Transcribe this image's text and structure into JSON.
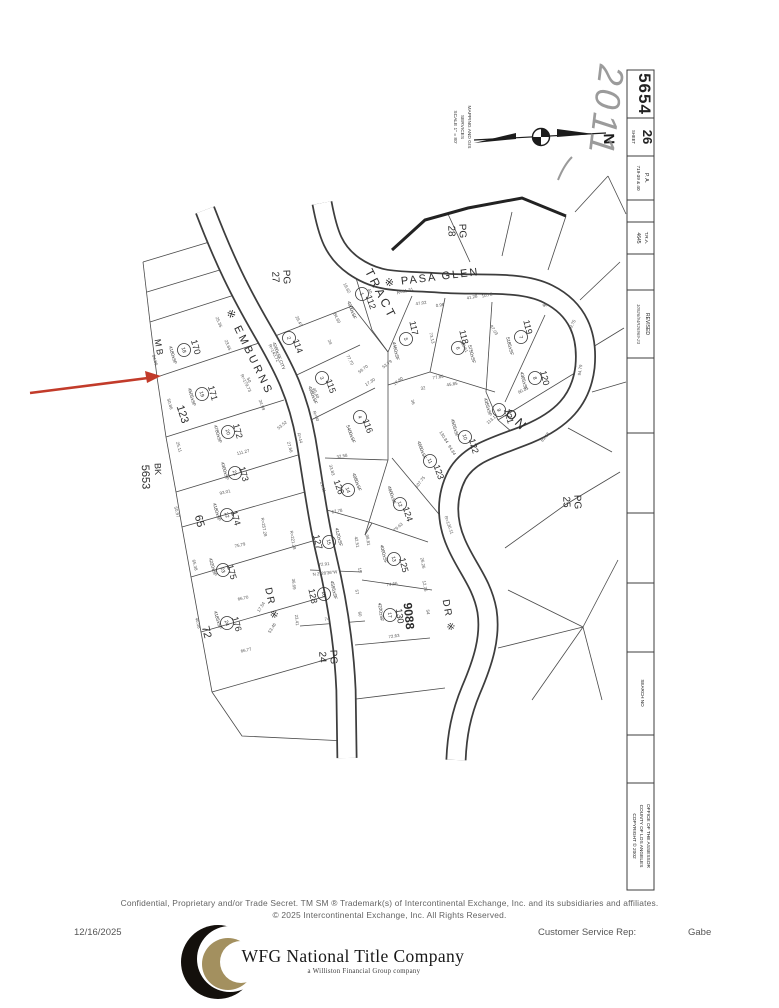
{
  "sidebar": {
    "book": "5654",
    "sheet_label": "SHEET",
    "sheet": "26",
    "pa_label": "P. A.",
    "pa_value": "719-39 & 40",
    "tra_label": "T.R.A.",
    "tra_value": "4645",
    "revised_label": "REVISED",
    "revised_value": "10926/94R26969-23",
    "search_label": "SEARCH NO",
    "office_line1": "OFFICE OF THE ASSESSOR",
    "office_line2": "COUNTY OF LOS ANGELES",
    "office_line3": "COPYRIGHT © 2002"
  },
  "compass": {
    "north": "N",
    "caption_line1": "MAPPING AND GIS",
    "caption_line2": "SERVICES",
    "caption_line3": "SCALE 1\" = 80'"
  },
  "annotations": {
    "handwritten_year": "2011",
    "pointer_color": "#c23b2a"
  },
  "map": {
    "labels": [
      {
        "t": "※ EMBURNS",
        "x": 250,
        "y": 352,
        "r": 64,
        "s": 11,
        "ls": 3
      },
      {
        "t": "DR ※",
        "x": 272,
        "y": 604,
        "r": 78,
        "s": 10,
        "ls": 2
      },
      {
        "t": "※ PASA GLEN",
        "x": 432,
        "y": 277,
        "r": -7,
        "s": 11,
        "ls": 2
      },
      {
        "t": "DR ※",
        "x": 449,
        "y": 616,
        "r": 80,
        "s": 10,
        "ls": 2
      },
      {
        "t": "TRACT",
        "x": 381,
        "y": 294,
        "r": 63,
        "s": 12,
        "ls": 3
      },
      {
        "t": "ON",
        "x": 517,
        "y": 420,
        "r": 45,
        "s": 13,
        "ls": 3
      },
      {
        "t": "9088",
        "x": 409,
        "y": 616,
        "r": 84,
        "s": 12,
        "w": 1
      },
      {
        "t": "M B",
        "x": 159,
        "y": 347,
        "r": 80,
        "s": 9
      },
      {
        "t": "BK",
        "x": 158,
        "y": 469,
        "r": 88,
        "s": 9
      },
      {
        "t": "5653",
        "x": 146,
        "y": 477,
        "r": 88,
        "s": 11
      },
      {
        "t": "PG",
        "x": 287,
        "y": 277,
        "r": 88,
        "s": 10
      },
      {
        "t": "27",
        "x": 276,
        "y": 277,
        "r": 88,
        "s": 10
      },
      {
        "t": "PG",
        "x": 463,
        "y": 231,
        "r": 88,
        "s": 10
      },
      {
        "t": "28",
        "x": 452,
        "y": 231,
        "r": 88,
        "s": 10
      },
      {
        "t": "PG",
        "x": 578,
        "y": 502,
        "r": 88,
        "s": 10
      },
      {
        "t": "25",
        "x": 567,
        "y": 502,
        "r": 88,
        "s": 10
      },
      {
        "t": "PG",
        "x": 334,
        "y": 657,
        "r": 88,
        "s": 10
      },
      {
        "t": "24",
        "x": 323,
        "y": 657,
        "r": 88,
        "s": 10
      },
      {
        "t": "123",
        "x": 183,
        "y": 414,
        "r": 72,
        "s": 11
      },
      {
        "t": "65",
        "x": 200,
        "y": 521,
        "r": 76,
        "s": 11
      },
      {
        "t": "72",
        "x": 207,
        "y": 632,
        "r": 76,
        "s": 11
      },
      {
        "t": "112",
        "x": 371,
        "y": 302,
        "r": 70,
        "s": 9
      },
      {
        "t": "1",
        "x": 362,
        "y": 294,
        "r": 70,
        "s": 5,
        "c": 1
      },
      {
        "t": "4000±SF",
        "x": 352,
        "y": 310,
        "r": 70,
        "s": 4.6
      },
      {
        "t": "114",
        "x": 298,
        "y": 346,
        "r": 70,
        "s": 9
      },
      {
        "t": "2",
        "x": 289,
        "y": 338,
        "r": 70,
        "s": 5,
        "c": 1
      },
      {
        "t": "4200±SF CITY",
        "x": 279,
        "y": 356,
        "r": 70,
        "s": 4.4
      },
      {
        "t": "115",
        "x": 331,
        "y": 386,
        "r": 70,
        "s": 9
      },
      {
        "t": "3",
        "x": 322,
        "y": 378,
        "r": 70,
        "s": 5,
        "c": 1
      },
      {
        "t": "4080±SF",
        "x": 313,
        "y": 395,
        "r": 70,
        "s": 4.6
      },
      {
        "t": "116",
        "x": 368,
        "y": 426,
        "r": 70,
        "s": 9
      },
      {
        "t": "4",
        "x": 360,
        "y": 417,
        "r": 70,
        "s": 5,
        "c": 1
      },
      {
        "t": "5400±SF",
        "x": 351,
        "y": 434,
        "r": 70,
        "s": 4.6
      },
      {
        "t": "117",
        "x": 414,
        "y": 328,
        "r": 78,
        "s": 9
      },
      {
        "t": "5",
        "x": 406,
        "y": 339,
        "r": 78,
        "s": 5,
        "c": 1
      },
      {
        "t": "4460±SF",
        "x": 396,
        "y": 351,
        "r": 78,
        "s": 4.6
      },
      {
        "t": "118",
        "x": 464,
        "y": 337,
        "r": 76,
        "s": 9
      },
      {
        "t": "6",
        "x": 458,
        "y": 348,
        "r": 76,
        "s": 5,
        "c": 1
      },
      {
        "t": "5750±SF",
        "x": 472,
        "y": 354,
        "r": 76,
        "s": 4.6
      },
      {
        "t": "119",
        "x": 528,
        "y": 327,
        "r": 76,
        "s": 9
      },
      {
        "t": "7",
        "x": 521,
        "y": 337,
        "r": 76,
        "s": 5,
        "c": 1
      },
      {
        "t": "5185±SF",
        "x": 510,
        "y": 346,
        "r": 76,
        "s": 4.6
      },
      {
        "t": "120",
        "x": 545,
        "y": 378,
        "r": 76,
        "s": 9
      },
      {
        "t": "8",
        "x": 535,
        "y": 378,
        "r": 76,
        "s": 5,
        "c": 1
      },
      {
        "t": "4305±SF",
        "x": 524,
        "y": 381,
        "r": 76,
        "s": 4.6
      },
      {
        "t": "121",
        "x": 509,
        "y": 416,
        "r": 74,
        "s": 9
      },
      {
        "t": "9",
        "x": 499,
        "y": 410,
        "r": 74,
        "s": 5,
        "c": 1
      },
      {
        "t": "4355±SF",
        "x": 488,
        "y": 407,
        "r": 74,
        "s": 4.6
      },
      {
        "t": "122",
        "x": 474,
        "y": 446,
        "r": 74,
        "s": 9
      },
      {
        "t": "10",
        "x": 465,
        "y": 437,
        "r": 74,
        "s": 5,
        "c": 1
      },
      {
        "t": "4505±SF",
        "x": 455,
        "y": 428,
        "r": 74,
        "s": 4.6
      },
      {
        "t": "123",
        "x": 439,
        "y": 472,
        "r": 70,
        "s": 9
      },
      {
        "t": "11",
        "x": 430,
        "y": 461,
        "r": 70,
        "s": 5,
        "c": 1
      },
      {
        "t": "4660±SF",
        "x": 422,
        "y": 450,
        "r": 70,
        "s": 4.6
      },
      {
        "t": "124",
        "x": 408,
        "y": 514,
        "r": 72,
        "s": 9
      },
      {
        "t": "12",
        "x": 400,
        "y": 504,
        "r": 72,
        "s": 5,
        "c": 1
      },
      {
        "t": "4600±SF",
        "x": 392,
        "y": 495,
        "r": 72,
        "s": 4.6
      },
      {
        "t": "125",
        "x": 404,
        "y": 565,
        "r": 76,
        "s": 9
      },
      {
        "t": "13",
        "x": 394,
        "y": 559,
        "r": 76,
        "s": 5,
        "c": 1
      },
      {
        "t": "4000±SF",
        "x": 384,
        "y": 554,
        "r": 76,
        "s": 4.6
      },
      {
        "t": "126",
        "x": 339,
        "y": 487,
        "r": 70,
        "s": 9
      },
      {
        "t": "14",
        "x": 348,
        "y": 490,
        "r": 70,
        "s": 5,
        "c": 1
      },
      {
        "t": "4080±SF",
        "x": 357,
        "y": 482,
        "r": 70,
        "s": 4.6
      },
      {
        "t": "127",
        "x": 318,
        "y": 542,
        "r": 76,
        "s": 9
      },
      {
        "t": "15",
        "x": 329,
        "y": 542,
        "r": 76,
        "s": 5,
        "c": 1
      },
      {
        "t": "4120±SF",
        "x": 339,
        "y": 537,
        "r": 76,
        "s": 4.6
      },
      {
        "t": "128",
        "x": 313,
        "y": 596,
        "r": 78,
        "s": 9
      },
      {
        "t": "16",
        "x": 324,
        "y": 594,
        "r": 78,
        "s": 5,
        "c": 1
      },
      {
        "t": "4595±SF",
        "x": 334,
        "y": 590,
        "r": 78,
        "s": 4.6
      },
      {
        "t": "130",
        "x": 400,
        "y": 616,
        "r": 82,
        "s": 9
      },
      {
        "t": "17",
        "x": 390,
        "y": 615,
        "r": 82,
        "s": 5,
        "c": 1
      },
      {
        "t": "4220±SF",
        "x": 381,
        "y": 612,
        "r": 82,
        "s": 4.6
      },
      {
        "t": "170",
        "x": 196,
        "y": 347,
        "r": 74,
        "s": 9
      },
      {
        "t": "18",
        "x": 184,
        "y": 350,
        "r": 74,
        "s": 5,
        "c": 1
      },
      {
        "t": "4180±SF",
        "x": 173,
        "y": 355,
        "r": 74,
        "s": 4.6
      },
      {
        "t": "171",
        "x": 213,
        "y": 393,
        "r": 74,
        "s": 9
      },
      {
        "t": "19",
        "x": 202,
        "y": 394,
        "r": 74,
        "s": 5,
        "c": 1
      },
      {
        "t": "4505±SF",
        "x": 192,
        "y": 397,
        "r": 74,
        "s": 4.6
      },
      {
        "t": "172",
        "x": 238,
        "y": 431,
        "r": 74,
        "s": 9
      },
      {
        "t": "20",
        "x": 228,
        "y": 432,
        "r": 74,
        "s": 5,
        "c": 1
      },
      {
        "t": "4780±SF",
        "x": 218,
        "y": 434,
        "r": 74,
        "s": 4.6
      },
      {
        "t": "173",
        "x": 244,
        "y": 474,
        "r": 74,
        "s": 9
      },
      {
        "t": "21",
        "x": 235,
        "y": 473,
        "r": 74,
        "s": 5,
        "c": 1
      },
      {
        "t": "4300±SF",
        "x": 225,
        "y": 471,
        "r": 74,
        "s": 4.6
      },
      {
        "t": "174",
        "x": 236,
        "y": 518,
        "r": 74,
        "s": 9
      },
      {
        "t": "22",
        "x": 227,
        "y": 515,
        "r": 74,
        "s": 5,
        "c": 1
      },
      {
        "t": "4180±SF",
        "x": 217,
        "y": 512,
        "r": 74,
        "s": 4.6
      },
      {
        "t": "175",
        "x": 232,
        "y": 572,
        "r": 74,
        "s": 9
      },
      {
        "t": "23",
        "x": 223,
        "y": 570,
        "r": 74,
        "s": 5,
        "c": 1
      },
      {
        "t": "4220±SF",
        "x": 213,
        "y": 567,
        "r": 74,
        "s": 4.6
      },
      {
        "t": "176",
        "x": 237,
        "y": 624,
        "r": 74,
        "s": 9
      },
      {
        "t": "24",
        "x": 227,
        "y": 623,
        "r": 74,
        "s": 5,
        "c": 1
      },
      {
        "t": "4185±SF",
        "x": 218,
        "y": 620,
        "r": 74,
        "s": 4.6
      }
    ],
    "dims": [
      {
        "t": "R=61.31",
        "x": 405,
        "y": 291,
        "r": -14
      },
      {
        "t": "47.02",
        "x": 421,
        "y": 303,
        "r": -8
      },
      {
        "t": "0.96",
        "x": 440,
        "y": 305,
        "r": -8
      },
      {
        "t": "41.28",
        "x": 472,
        "y": 297,
        "r": -12
      },
      {
        "t": "10.72",
        "x": 487,
        "y": 295,
        "r": -12
      },
      {
        "t": "19.62",
        "x": 347,
        "y": 288,
        "r": 62
      },
      {
        "t": "40",
        "x": 370,
        "y": 291,
        "r": 62
      },
      {
        "t": "84.60",
        "x": 337,
        "y": 318,
        "r": 64
      },
      {
        "t": "29.47",
        "x": 299,
        "y": 321,
        "r": 64
      },
      {
        "t": "25.35",
        "x": 219,
        "y": 322,
        "r": 68
      },
      {
        "t": "23.65",
        "x": 228,
        "y": 345,
        "r": 68
      },
      {
        "t": "64.86",
        "x": 155,
        "y": 360,
        "r": 74
      },
      {
        "t": "50.86",
        "x": 170,
        "y": 404,
        "r": 74
      },
      {
        "t": "25.11",
        "x": 179,
        "y": 447,
        "r": 74
      },
      {
        "t": "50.97",
        "x": 177,
        "y": 512,
        "r": 76
      },
      {
        "t": "65.38",
        "x": 195,
        "y": 565,
        "r": 76
      },
      {
        "t": "40.08",
        "x": 198,
        "y": 623,
        "r": 76
      },
      {
        "t": "93.01",
        "x": 225,
        "y": 492,
        "r": -14
      },
      {
        "t": "111.27",
        "x": 243,
        "y": 452,
        "r": -14
      },
      {
        "t": "75.79",
        "x": 240,
        "y": 545,
        "r": -13
      },
      {
        "t": "66.70",
        "x": 243,
        "y": 598,
        "r": -12
      },
      {
        "t": "66.77",
        "x": 246,
        "y": 650,
        "r": -12
      },
      {
        "t": "R=179.73",
        "x": 246,
        "y": 383,
        "r": 64
      },
      {
        "t": "R=143.72",
        "x": 274,
        "y": 353,
        "r": 64
      },
      {
        "t": "R=257.28",
        "x": 264,
        "y": 527,
        "r": 80
      },
      {
        "t": "R=221.28",
        "x": 293,
        "y": 540,
        "r": 80
      },
      {
        "t": "36.69",
        "x": 294,
        "y": 584,
        "r": 84
      },
      {
        "t": "23.41",
        "x": 297,
        "y": 620,
        "r": 84
      },
      {
        "t": "74",
        "x": 327,
        "y": 619,
        "r": -8
      },
      {
        "t": "72.91",
        "x": 324,
        "y": 564,
        "r": -6
      },
      {
        "t": "N 2°28'36\"W",
        "x": 325,
        "y": 573,
        "r": -6
      },
      {
        "t": "67.78",
        "x": 337,
        "y": 511,
        "r": -10
      },
      {
        "t": "74.66",
        "x": 392,
        "y": 584,
        "r": -8
      },
      {
        "t": "72.63",
        "x": 394,
        "y": 636,
        "r": -8
      },
      {
        "t": "79.63",
        "x": 398,
        "y": 527,
        "r": -42
      },
      {
        "t": "26.26",
        "x": 423,
        "y": 563,
        "r": 80
      },
      {
        "t": "12.76",
        "x": 425,
        "y": 586,
        "r": 80
      },
      {
        "t": "R=136.11",
        "x": 449,
        "y": 525,
        "r": 70
      },
      {
        "t": "77.85",
        "x": 438,
        "y": 377,
        "r": -9
      },
      {
        "t": "45.85",
        "x": 452,
        "y": 384,
        "r": -9
      },
      {
        "t": "32",
        "x": 423,
        "y": 388,
        "r": -9
      },
      {
        "t": "53.79",
        "x": 387,
        "y": 364,
        "r": -38
      },
      {
        "t": "17.80",
        "x": 398,
        "y": 381,
        "r": -38
      },
      {
        "t": "77.70",
        "x": 350,
        "y": 360,
        "r": 62
      },
      {
        "t": "59.70",
        "x": 363,
        "y": 369,
        "r": -38
      },
      {
        "t": "17.30",
        "x": 370,
        "y": 382,
        "r": -32
      },
      {
        "t": "24",
        "x": 330,
        "y": 342,
        "r": 66
      },
      {
        "t": "107.75",
        "x": 420,
        "y": 482,
        "r": -52
      },
      {
        "t": "94.84",
        "x": 452,
        "y": 450,
        "r": 58
      },
      {
        "t": "130.84",
        "x": 444,
        "y": 437,
        "r": 58
      },
      {
        "t": "32.58",
        "x": 342,
        "y": 456,
        "r": -10
      },
      {
        "t": "33.83",
        "x": 332,
        "y": 470,
        "r": 74
      },
      {
        "t": "21.11",
        "x": 323,
        "y": 487,
        "r": 74
      },
      {
        "t": "R=90",
        "x": 316,
        "y": 416,
        "r": 68
      },
      {
        "t": "40.40",
        "x": 316,
        "y": 393,
        "r": 68
      },
      {
        "t": "R=44",
        "x": 300,
        "y": 438,
        "r": 74
      },
      {
        "t": "24.99",
        "x": 262,
        "y": 405,
        "r": 70
      },
      {
        "t": "27.66",
        "x": 290,
        "y": 447,
        "r": 74
      },
      {
        "t": "53.52",
        "x": 282,
        "y": 425,
        "r": -40
      },
      {
        "t": "205.61",
        "x": 464,
        "y": 346,
        "r": 64
      },
      {
        "t": "97.03",
        "x": 494,
        "y": 330,
        "r": 58
      },
      {
        "t": "90.21",
        "x": 523,
        "y": 390,
        "r": -28
      },
      {
        "t": "81.18",
        "x": 545,
        "y": 437,
        "r": -48
      },
      {
        "t": "113.12",
        "x": 492,
        "y": 419,
        "r": -40
      },
      {
        "t": "49.75",
        "x": 572,
        "y": 325,
        "r": -64
      },
      {
        "t": "94.79",
        "x": 580,
        "y": 370,
        "r": -82
      },
      {
        "t": "98",
        "x": 545,
        "y": 305,
        "r": -20
      },
      {
        "t": "42.51",
        "x": 357,
        "y": 542,
        "r": 80
      },
      {
        "t": "98.81",
        "x": 368,
        "y": 540,
        "r": 80
      },
      {
        "t": "73.13",
        "x": 432,
        "y": 338,
        "r": 76
      },
      {
        "t": "57",
        "x": 357,
        "y": 592,
        "r": 80
      },
      {
        "t": "15",
        "x": 360,
        "y": 570,
        "r": 80
      },
      {
        "t": "60",
        "x": 360,
        "y": 614,
        "r": 80
      },
      {
        "t": "54",
        "x": 428,
        "y": 612,
        "r": 80
      },
      {
        "t": "36",
        "x": 413,
        "y": 402,
        "r": 72
      },
      {
        "t": "17.54",
        "x": 261,
        "y": 607,
        "r": -58
      },
      {
        "t": "53.46",
        "x": 272,
        "y": 628,
        "r": -58
      },
      {
        "t": "50",
        "x": 249,
        "y": 380,
        "r": 68
      }
    ]
  },
  "footer": {
    "confidential_line": "Confidential, Proprietary and/or Trade Secret.  TM SM  ® Trademark(s) of Intercontinental Exchange, Inc. and its subsidiaries and affiliates.",
    "rights_line": "© 2025 Intercontinental Exchange, Inc. All Rights Reserved.",
    "date": "12/16/2025",
    "rep_label": "Customer Service Rep:",
    "rep_name": "Gabe",
    "logo_title": "WFG National Title Company",
    "logo_subtitle": "a Williston Financial Group company",
    "logo_black": "#14100c",
    "logo_gold": "#a3905f"
  }
}
